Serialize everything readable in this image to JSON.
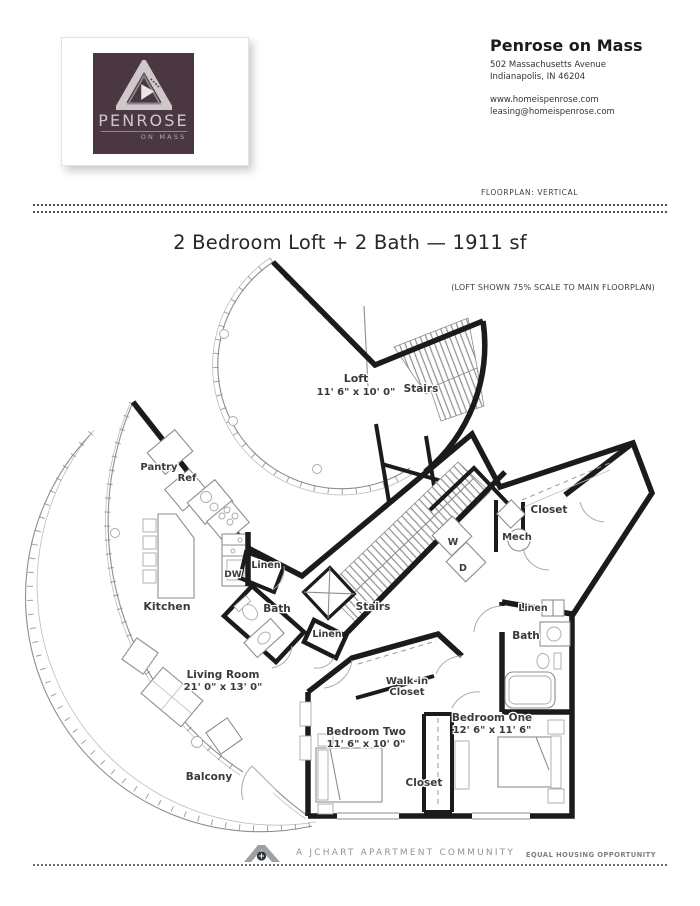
{
  "header": {
    "brand_name": "Penrose on Mass",
    "address_line1": "502 Massachusetts Avenue",
    "address_line2": "Indianapolis, IN 46204",
    "website": "www.homeispenrose.com",
    "email": "leasing@homeispenrose.com",
    "floorplan_tag": "FLOORPLAN: VERTICAL"
  },
  "logo": {
    "wordmark": "PENROSE",
    "sub": "ON MASS",
    "bg_color": "#4b3741"
  },
  "plan": {
    "title": "2 Bedroom Loft + 2 Bath — 1911 sf",
    "scale_note": "(LOFT SHOWN 75% SCALE TO MAIN FLOORPLAN)"
  },
  "footer": {
    "community": "A JCHART APARTMENT COMMUNITY",
    "equal_housing": "EQUAL HOUSING OPPORTUNITY"
  },
  "colors": {
    "wall": "#1b1b1b",
    "thin_line": "#8e8e8e",
    "logo_bg": "#4b3741"
  },
  "floorplan": {
    "labels": [
      {
        "text": "Loft",
        "x": 356,
        "y": 382,
        "fs": 11
      },
      {
        "text": "11' 6\" x 10' 0\"",
        "x": 356,
        "y": 395,
        "fs": 10
      },
      {
        "text": "Stairs",
        "x": 421,
        "y": 392,
        "fs": 10.5
      },
      {
        "text": "Pantry",
        "x": 159,
        "y": 470,
        "fs": 10
      },
      {
        "text": "Ref",
        "x": 187,
        "y": 481,
        "fs": 10
      },
      {
        "text": "Kitchen",
        "x": 167,
        "y": 610,
        "fs": 11
      },
      {
        "text": "DW",
        "x": 233,
        "y": 577,
        "fs": 9
      },
      {
        "text": "Linen",
        "x": 266,
        "y": 568,
        "fs": 9.5
      },
      {
        "text": "Bath",
        "x": 277,
        "y": 612,
        "fs": 10.5
      },
      {
        "text": "Linen",
        "x": 327,
        "y": 637,
        "fs": 9.5
      },
      {
        "text": "Stairs",
        "x": 373,
        "y": 610,
        "fs": 10.5
      },
      {
        "text": "W",
        "x": 453,
        "y": 545,
        "fs": 9.5
      },
      {
        "text": "D",
        "x": 463,
        "y": 571,
        "fs": 9.5
      },
      {
        "text": "Mech",
        "x": 517,
        "y": 540,
        "fs": 10
      },
      {
        "text": "Closet",
        "x": 549,
        "y": 513,
        "fs": 10.5
      },
      {
        "text": "Linen",
        "x": 533,
        "y": 611,
        "fs": 9.5
      },
      {
        "text": "Bath",
        "x": 526,
        "y": 639,
        "fs": 10.5
      },
      {
        "text": "Walk-in",
        "x": 407,
        "y": 684,
        "fs": 10
      },
      {
        "text": "Closet",
        "x": 407,
        "y": 695,
        "fs": 10
      },
      {
        "text": "Bedroom One",
        "x": 492,
        "y": 721,
        "fs": 10.5
      },
      {
        "text": "12' 6\" x 11' 6\"",
        "x": 492,
        "y": 733,
        "fs": 10
      },
      {
        "text": "Bedroom Two",
        "x": 366,
        "y": 735,
        "fs": 10.5
      },
      {
        "text": "11' 6\" x 10' 0\"",
        "x": 366,
        "y": 747,
        "fs": 10
      },
      {
        "text": "Closet",
        "x": 424,
        "y": 786,
        "fs": 10.5
      },
      {
        "text": "Living Room",
        "x": 223,
        "y": 678,
        "fs": 10.5
      },
      {
        "text": "21' 0\" x 13' 0\"",
        "x": 223,
        "y": 690,
        "fs": 10
      },
      {
        "text": "Balcony",
        "x": 209,
        "y": 780,
        "fs": 10.5
      }
    ]
  }
}
